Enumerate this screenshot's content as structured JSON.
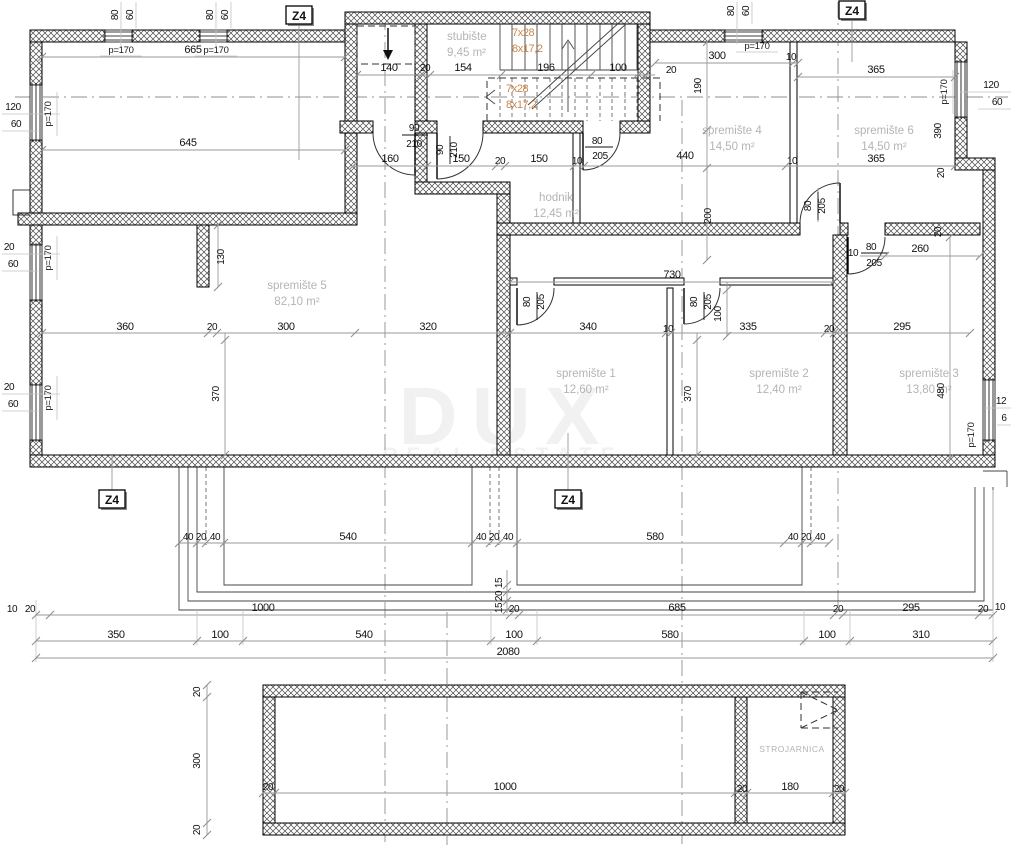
{
  "watermark": {
    "brand": "DUX",
    "tagline": "REAL ESTATE"
  },
  "marker": {
    "label": "Z4"
  },
  "parapet": {
    "label": "p=170"
  },
  "stairs": {
    "run": "7x28",
    "rise": "8x17,2"
  },
  "rooms": {
    "stubiste": {
      "name": "stubište",
      "area": "9,45 m²"
    },
    "spremiste4": {
      "name": "spremište 4",
      "area": "14,50 m²"
    },
    "spremiste6": {
      "name": "spremište 6",
      "area": "14,50 m²"
    },
    "hodnik": {
      "name": "hodnik",
      "area": "12,45 m²"
    },
    "spremiste5": {
      "name": "spremište 5",
      "area": "82,10 m²"
    },
    "spremiste1": {
      "name": "spremište 1",
      "area": "12,60 m²"
    },
    "spremiste2": {
      "name": "spremište 2",
      "area": "12,40 m²"
    },
    "spremiste3": {
      "name": "spremište 3",
      "area": "13,80 m²"
    },
    "strojarnica": {
      "name": "STROJARNICA",
      "area": ""
    }
  },
  "dims": {
    "winpair": [
      "80",
      "60"
    ],
    "lwin": [
      "120",
      "60",
      "20",
      "60",
      "20",
      "60"
    ],
    "rwin": [
      "120",
      "60",
      "12",
      "6"
    ],
    "top": [
      "665",
      "645"
    ],
    "stairline": [
      "140",
      "20",
      "154",
      "196",
      "100",
      "20"
    ],
    "l166": [
      "160",
      "150",
      "20",
      "150",
      "10",
      "440",
      "10",
      "365"
    ],
    "upright": [
      "300",
      "10",
      "365",
      "190",
      "390",
      "20",
      "200",
      "20"
    ],
    "mid": [
      "360",
      "20",
      "300",
      "320",
      "340",
      "10",
      "335",
      "20",
      "295"
    ],
    "vert": [
      "130",
      "370",
      "370",
      "480",
      "730",
      "100",
      "260",
      "10"
    ],
    "d90": [
      "90",
      "210"
    ],
    "d80": [
      "80",
      "205"
    ],
    "terr": [
      "40",
      "20",
      "40",
      "540",
      "40",
      "20",
      "40",
      "580",
      "40",
      "20",
      "40"
    ],
    "notch": [
      "15",
      "20",
      "15"
    ],
    "lineA": [
      "10",
      "20",
      "1000",
      "20",
      "685",
      "20",
      "295",
      "20",
      "10"
    ],
    "lineB": [
      "350",
      "100",
      "540",
      "100",
      "580",
      "100",
      "310"
    ],
    "total": "2080",
    "pool": [
      "20",
      "300",
      "20",
      "20",
      "1000",
      "20",
      "180",
      "20"
    ]
  },
  "colors": {
    "stair_text": "#c9874f",
    "room_label": "#b4b4b4",
    "dim_line": "#9a9a9a"
  }
}
